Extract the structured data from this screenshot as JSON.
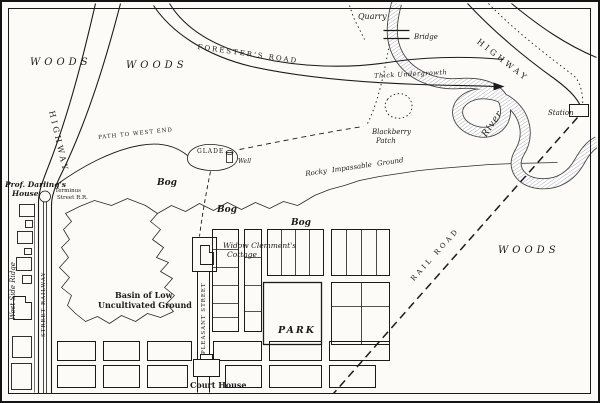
{
  "map": {
    "title": "Hand-drawn village and countryside map",
    "ink_color": "#1b1b1b",
    "paper_color": "#fcfbf7",
    "labels": {
      "woods_nw": "WOODS",
      "woods_n": "WOODS",
      "woods_e": "WOODS",
      "highway_w": "HIGHWAY",
      "highway_ne": "HIGHWAY",
      "foresters_road": "FORESTER'S ROAD",
      "quarry": "Quarry",
      "bridge": "Bridge",
      "river": "River",
      "station": "Station",
      "thick_undergrowth": "Thick Undergrowth",
      "blackberry_line1": "Blackberry",
      "blackberry_line2": "Patch",
      "rocky_ground": "Rocky Impassable Ground",
      "glade": "GLADE",
      "well": "Well",
      "path_west": "PATH TO WEST END",
      "bog_1": "Bog",
      "bog_2": "Bog",
      "bog_3": "Bog",
      "prof_darling_line1": "Prof. Darling's",
      "prof_darling_line2": "House",
      "terminus_line1": "Terminus",
      "terminus_line2": "Street R.R.",
      "west_side_ridge": "West Side Ridge",
      "street_railway": "STREET RAILWAY",
      "basin_line1": "Basin of Low",
      "basin_line2": "Uncultivated Ground",
      "widow_line1": "Widow Clemment's",
      "widow_line2": "Cottage",
      "pleasant_street": "PLEASANT STREET",
      "park": "PARK",
      "court_house": "Court House",
      "rail_road": "RAIL ROAD"
    }
  }
}
